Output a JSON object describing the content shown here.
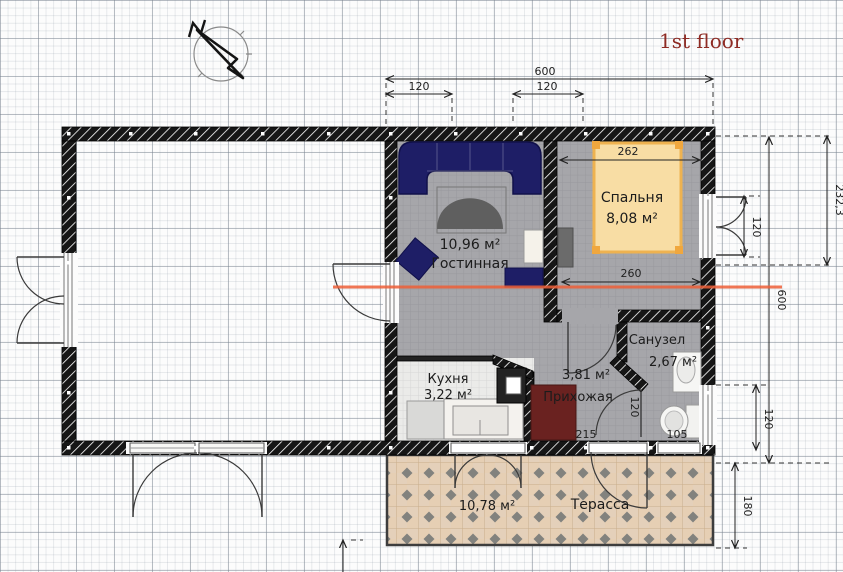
{
  "page": {
    "title": "1st floor"
  },
  "compass": {
    "label": "N"
  },
  "rooms": {
    "living": {
      "name": "Гостинная",
      "area": "10,96 м²"
    },
    "bedroom": {
      "name": "Спальня",
      "area": "8,08 м²"
    },
    "kitchen": {
      "name": "Кухня",
      "area": "3,22 м²"
    },
    "hallway": {
      "name": "Прихожая",
      "area": "3,81 м²"
    },
    "bathroom": {
      "name": "Санузел",
      "area": "2,67 м²"
    },
    "terrace": {
      "name": "Терасса",
      "area": "10,78 м²"
    }
  },
  "dims": {
    "top_total": "600",
    "top_seg_left": "120",
    "top_seg_right": "120",
    "bed_head": "262",
    "bed_foot": "260",
    "right_upper": "232,3",
    "right_total": "600",
    "bedroom_window": "120",
    "bathroom_window": "120",
    "terrace_depth": "180",
    "hallway_width": "215",
    "bath_door": "120",
    "toilet_width": "105"
  },
  "colors": {
    "title": "#8e2b24",
    "section_line": "#ee5f38",
    "wall": "#161616",
    "sofa": "#1e1e66",
    "bed_fill": "#f8dda4",
    "bed_frame": "#eeb250",
    "wardrobe": "#6a2220",
    "terrace_tile": "#e4d0ba",
    "floor_gray": "#a6a6aa"
  }
}
